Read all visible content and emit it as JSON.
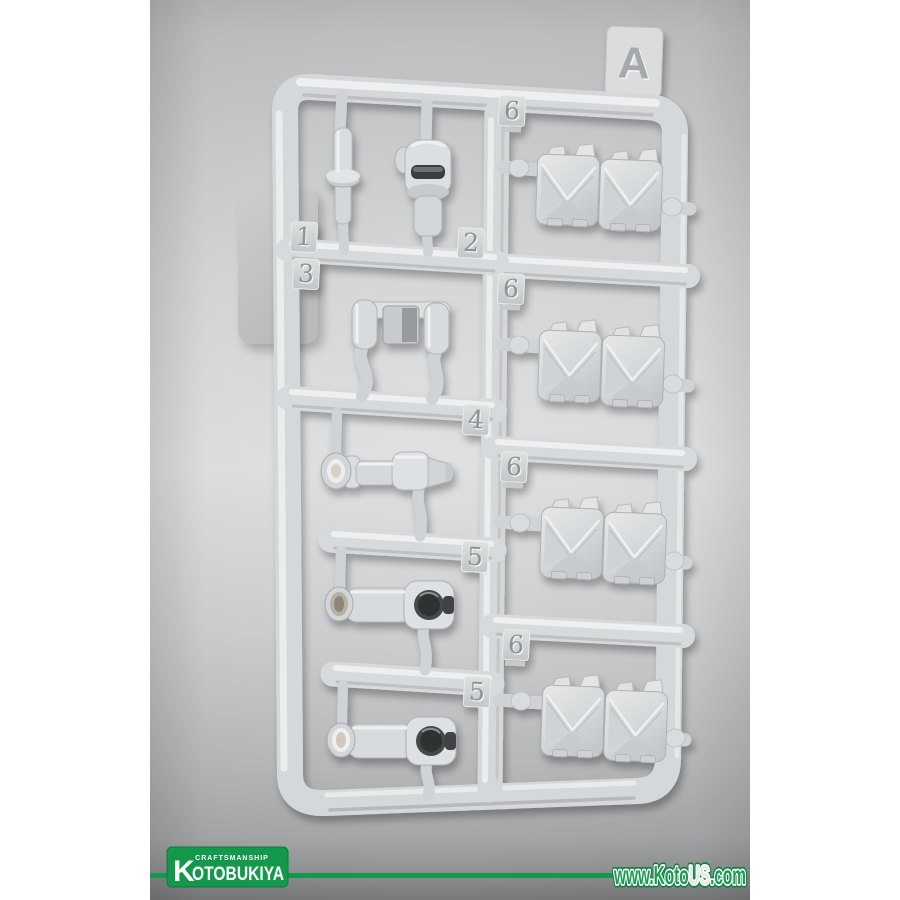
{
  "meta": {
    "title": "Kotobukiya model kit runner sprue photo"
  },
  "photo": {
    "background_top": "#b2b4b6",
    "background_middle": "#d8dadb",
    "background_lower": "#a6a8aa",
    "background_bottom_edge": "#747678",
    "plastic_color": "#d6d9db"
  },
  "sprue": {
    "runner_label": "A",
    "tags": [
      {
        "label": "1"
      },
      {
        "label": "2"
      },
      {
        "label": "3"
      },
      {
        "label": "4"
      },
      {
        "label": "5"
      },
      {
        "label": "5"
      },
      {
        "label": "6"
      },
      {
        "label": "6"
      },
      {
        "label": "6"
      },
      {
        "label": "6"
      }
    ]
  },
  "footer": {
    "tagline": "CRAFTSMANSHIP",
    "brand": "KOTOBUKIYA",
    "brand_initial": "K",
    "brand_rest": "OTOBUKIYA",
    "brand_color": "#149a4d",
    "website": {
      "text": "www.KotoUS.com",
      "part1": "www.Koto",
      "part2": "US",
      "part3": ".com",
      "color": "#1a9b50"
    }
  }
}
